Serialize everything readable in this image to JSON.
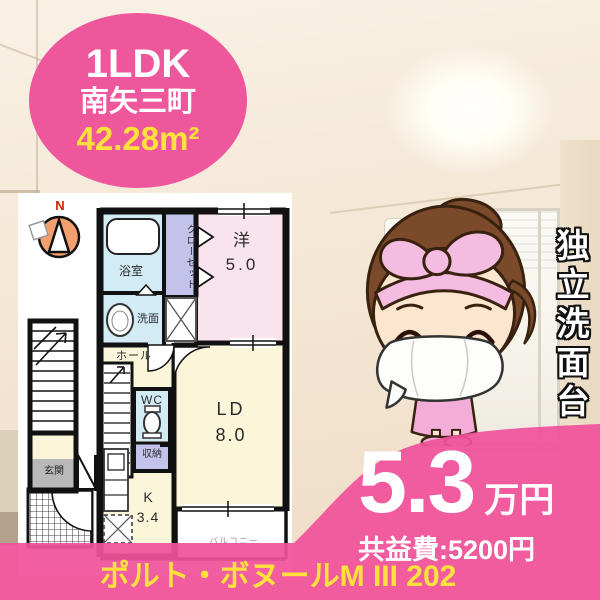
{
  "badge": {
    "layout": "1LDK",
    "location": "南矢三町",
    "area": "42.28m²"
  },
  "floorplan": {
    "compass": "N",
    "bath": "浴室",
    "closet": "クローゼット",
    "western_room": "洋",
    "western_size": "5.0",
    "washstand": "洗面",
    "hall": "ホール",
    "wc": "WC",
    "storage": "収納",
    "living_dining": "LD",
    "living_size": "8.0",
    "kitchen": "K",
    "kitchen_size": "3.4",
    "entrance": "玄関",
    "balcony": "バルコニー"
  },
  "feature": {
    "vertical_tag": "独立洗面台"
  },
  "price": {
    "rent": "5.3",
    "rent_unit": "万円",
    "common_fee": "共益費:5200円"
  },
  "footer": {
    "property_name": "ポルト・ボヌールM III 202"
  },
  "colors": {
    "accent_pink": "#f0529b",
    "accent_yellow": "#ffe13c"
  }
}
